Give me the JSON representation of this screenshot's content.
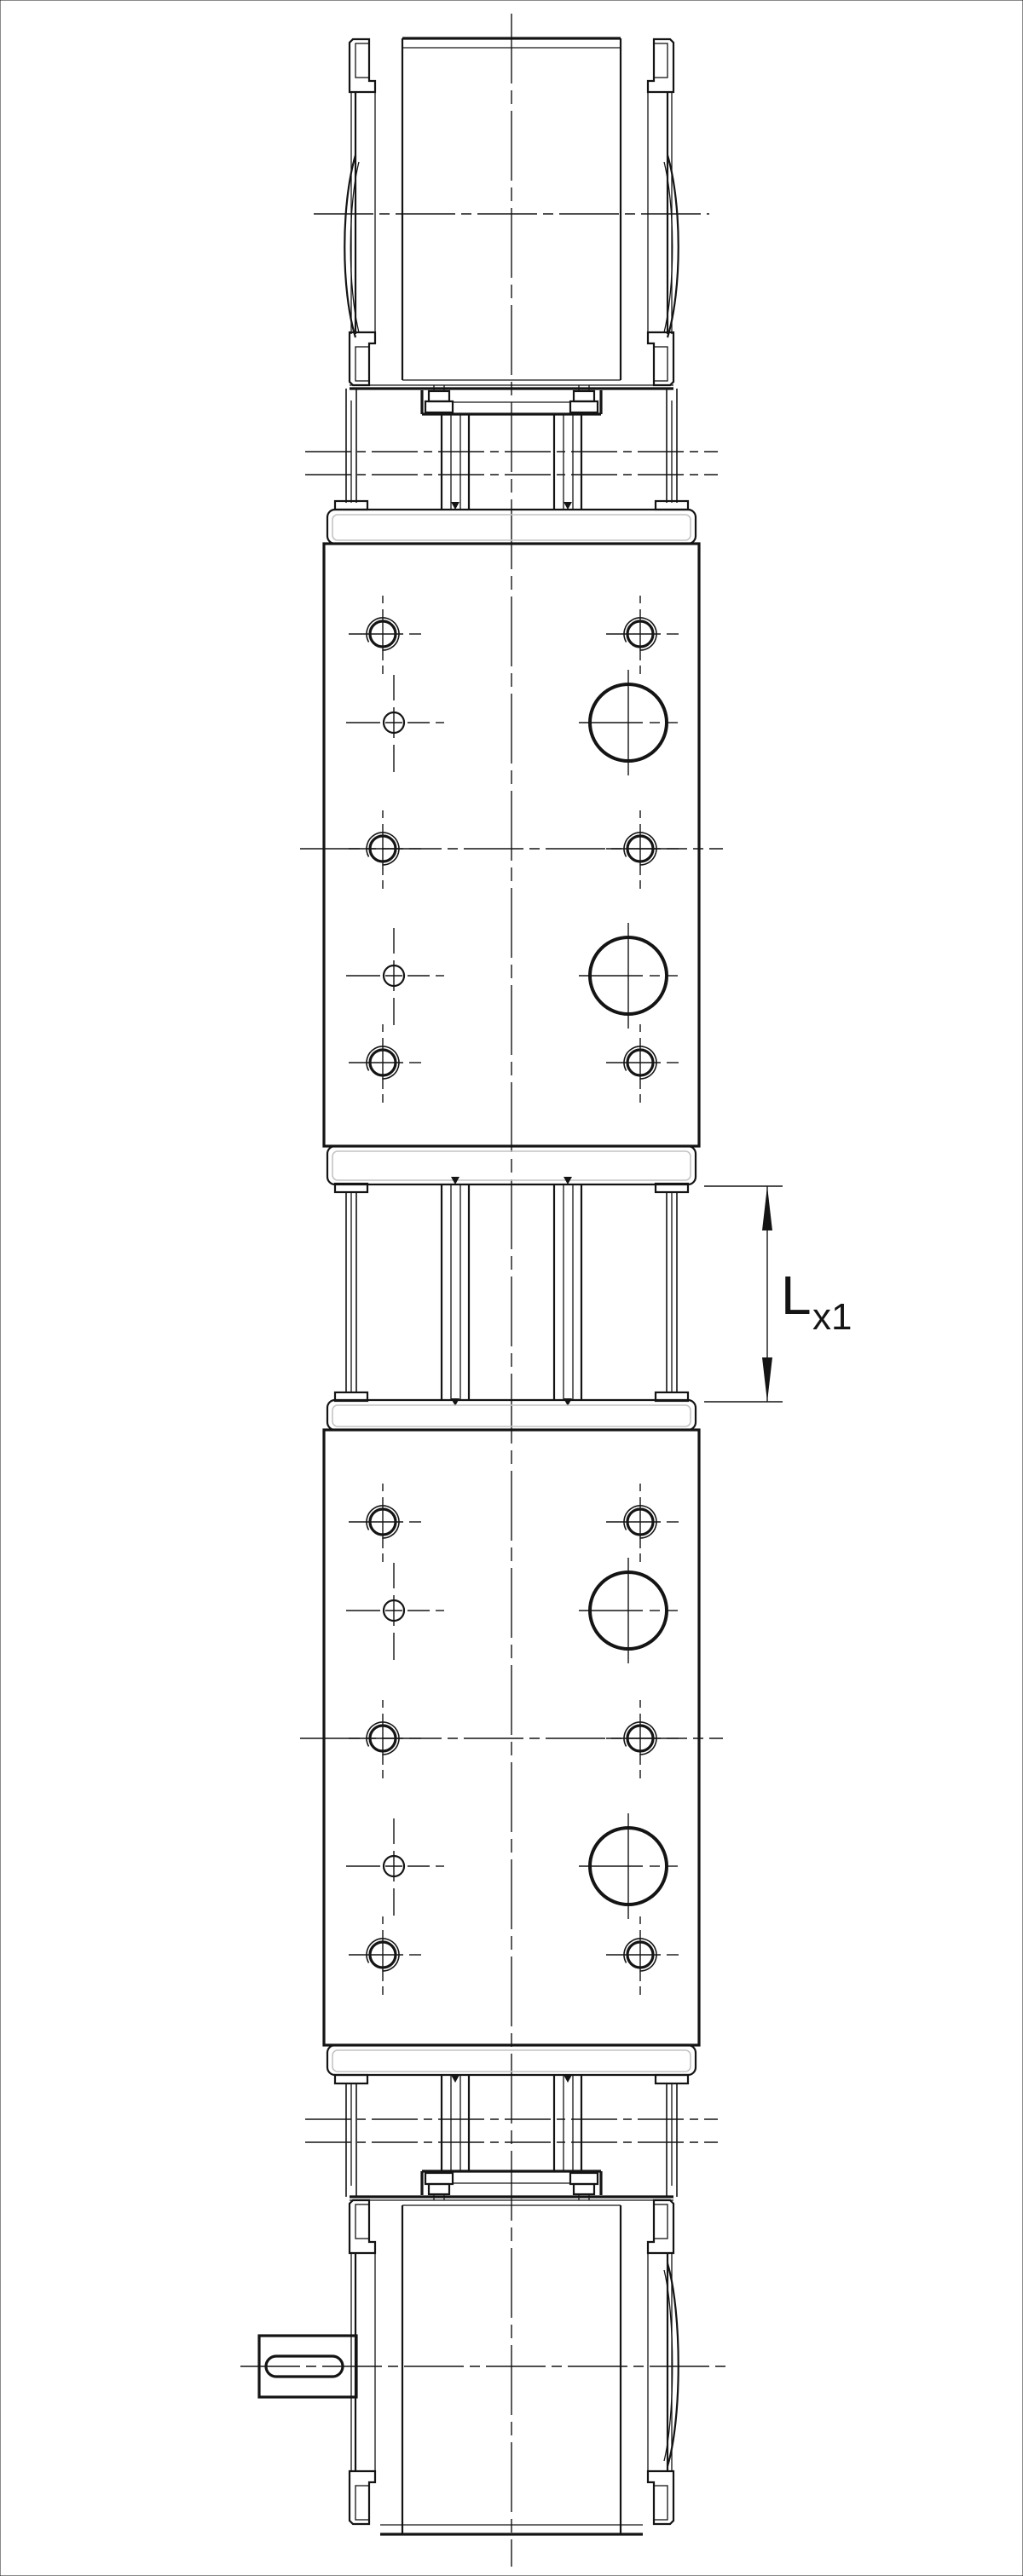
{
  "page": {
    "background_color": "#ffffff",
    "line_color": "#141414",
    "plate_highlight_color": "#c4c4c4",
    "drawing_type": "technical-drawing-2d"
  },
  "dimension": {
    "label_main": "L",
    "label_sub": "x1",
    "orientation": "vertical",
    "measures": "extension-gap-between-upper-and-lower-unit"
  },
  "components": {
    "top_motor": "motor-rear-view-top",
    "top_coupling": "motor-adapter-with-tie-rods",
    "upper_block": "actuator-block-with-threaded-holes",
    "stroke_gap": "tie-rod-extension-gap",
    "lower_block": "actuator-block-with-threaded-holes",
    "bottom_coupling": "motor-adapter-with-tie-rods",
    "bottom_motor": "motor-with-keyed-output-shaft"
  },
  "hole_pattern": {
    "rows_per_block": 5,
    "row_types": [
      "threaded-pair",
      "small-left-large-right",
      "threaded-pair-on-centerline",
      "small-left-large-right",
      "threaded-pair"
    ]
  }
}
